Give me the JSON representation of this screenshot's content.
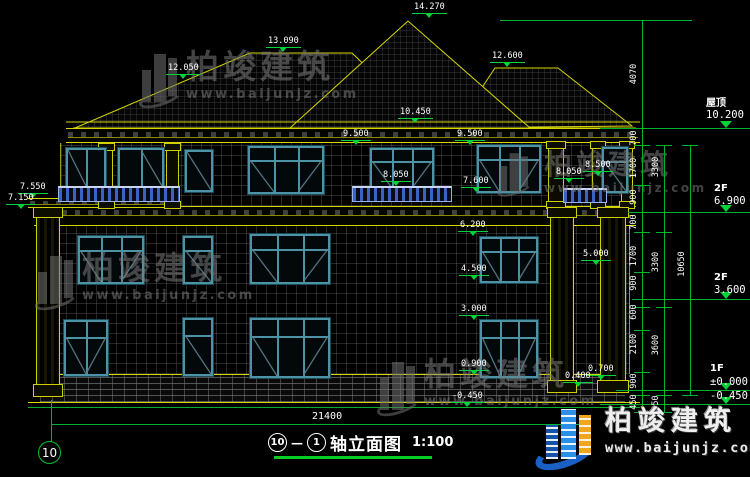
{
  "title_block": {
    "axis_from": "10",
    "connector": "—",
    "axis_to": "1",
    "title": "轴立面图",
    "scale": "1:100"
  },
  "axis_bubble": "10",
  "bottom_dimension": "21400",
  "watermark": {
    "brand": "柏竣建筑",
    "site": "www.baijunjz.com"
  },
  "logo": {
    "brand": "柏竣建筑",
    "site": "www.baijunjz.com"
  },
  "elevation_markers": [
    {
      "v": "14.270",
      "x": 412,
      "y": 2
    },
    {
      "v": "13.090",
      "x": 266,
      "y": 36
    },
    {
      "v": "12.050",
      "x": 166,
      "y": 63
    },
    {
      "v": "12.600",
      "x": 490,
      "y": 51
    },
    {
      "v": "10.450",
      "x": 398,
      "y": 107
    },
    {
      "v": "9.500",
      "x": 341,
      "y": 129
    },
    {
      "v": "9.500",
      "x": 455,
      "y": 129
    },
    {
      "v": "8.500",
      "x": 583,
      "y": 160
    },
    {
      "v": "8.050",
      "x": 381,
      "y": 170
    },
    {
      "v": "8.050",
      "x": 554,
      "y": 167
    },
    {
      "v": "7.600",
      "x": 461,
      "y": 176
    },
    {
      "v": "7.550",
      "x": 18,
      "y": 182
    },
    {
      "v": "7.150",
      "x": 6,
      "y": 193
    },
    {
      "v": "6.200",
      "x": 458,
      "y": 220
    },
    {
      "v": "5.000",
      "x": 581,
      "y": 249
    },
    {
      "v": "4.500",
      "x": 459,
      "y": 264
    },
    {
      "v": "3.000",
      "x": 459,
      "y": 304
    },
    {
      "v": "0.900",
      "x": 459,
      "y": 359
    },
    {
      "v": "0.700",
      "x": 586,
      "y": 364
    },
    {
      "v": "0.400",
      "x": 563,
      "y": 371
    },
    {
      "v": "-0.450",
      "x": 450,
      "y": 391
    }
  ],
  "dim_labels": [
    {
      "v": "4070",
      "x": 641,
      "y": 74
    },
    {
      "v": "700",
      "x": 641,
      "y": 138
    },
    {
      "v": "1700",
      "x": 641,
      "y": 168
    },
    {
      "v": "900",
      "x": 641,
      "y": 197
    },
    {
      "v": "700",
      "x": 641,
      "y": 222
    },
    {
      "v": "1700",
      "x": 641,
      "y": 256
    },
    {
      "v": "900",
      "x": 641,
      "y": 283
    },
    {
      "v": "600",
      "x": 641,
      "y": 312
    },
    {
      "v": "2100",
      "x": 641,
      "y": 344
    },
    {
      "v": "900",
      "x": 641,
      "y": 381
    },
    {
      "v": "450",
      "x": 641,
      "y": 402
    },
    {
      "v": "3300",
      "x": 663,
      "y": 167
    },
    {
      "v": "3300",
      "x": 663,
      "y": 262
    },
    {
      "v": "3600",
      "x": 663,
      "y": 345
    },
    {
      "v": "450",
      "x": 663,
      "y": 403
    },
    {
      "v": "10650",
      "x": 689,
      "y": 264
    }
  ],
  "levels": [
    {
      "label": "屋顶",
      "value": "10.200",
      "x": 706,
      "label_y": 94,
      "value_y": 109,
      "line_y": 128
    },
    {
      "label": "2F",
      "value": "6.900",
      "x": 714,
      "label_y": 183,
      "value_y": 195,
      "line_y": 212
    },
    {
      "label": "2F",
      "value": "3.600",
      "x": 714,
      "label_y": 272,
      "value_y": 284,
      "line_y": 299
    },
    {
      "label": "1F",
      "value": "±0.000",
      "x": 710,
      "label_y": 363,
      "value_y": 376,
      "line_y": 390
    },
    {
      "label": "",
      "value": "-0.450",
      "x": 710,
      "label_y": 0,
      "value_y": 390,
      "line_y": 404
    }
  ]
}
